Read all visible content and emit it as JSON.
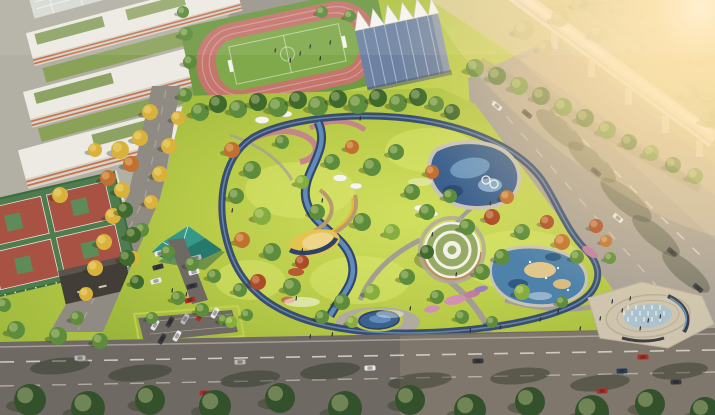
{
  "scene": {
    "label": "aerial-rendering-community-park-masterplan",
    "palette": {
      "lawn": "#aec544",
      "lawnLight": "#d8e468",
      "trackPink": "#c4756c",
      "pitchGreen": "#7fa94b",
      "gymGlass": "#6d82a2",
      "membraneWhite": "#f6f4ef",
      "schoolWhite": "#edeae3",
      "schoolFacade": "#d8d2c8",
      "accentOrange": "#c2764f",
      "roofGreen": "#8ca364",
      "streetGray": "#8f8a82",
      "rightRoad": "#a8a198",
      "bottomRoad": "#6f6963",
      "parkPath": "#a9a399",
      "loopNavy": "#34476b",
      "loopBlue": "#6c93c2",
      "streamBlue": "#5f8cba",
      "water": "#3c618f",
      "waterLight": "#6f9cc6",
      "poolPlay": "#4f82ab",
      "sand": "#e5c351",
      "sandLight": "#e2c78c",
      "pavilionTeal": "#35998a",
      "pavilionTealDark": "#27796d",
      "ringRoofGreen": "#95ab64",
      "ringRoofWhite": "#f3f0e8",
      "courtGreen": "#4e7c4e",
      "courtRed": "#a85244",
      "darkBuilding": "#433d37",
      "viaduct": "#e9e3d9",
      "plaza": "#cfc5ae",
      "fountainWater": "#a7c2d0",
      "glow": "#ffe4b0",
      "treeGreen": "#5d8c3c",
      "treeDark": "#3e6a2d",
      "treeLight": "#86ae3f",
      "treeYellow": "#d9b23c",
      "treeOrange": "#c2702f",
      "treeRed": "#ad4a28",
      "treeHazy": "#a3a86b",
      "treeBottom": "#33522b"
    },
    "carColors": {
      "w": "#e9e9e9",
      "s": "#b9b9b9",
      "d": "#3a3a3f",
      "r": "#b03028",
      "b": "#2e3f5e"
    },
    "trees": [
      [
        200,
        112,
        9,
        "g"
      ],
      [
        218,
        104,
        9,
        "dg"
      ],
      [
        238,
        109,
        9,
        "g"
      ],
      [
        258,
        102,
        9,
        "dg"
      ],
      [
        278,
        107,
        10,
        "g"
      ],
      [
        298,
        100,
        9,
        "dg"
      ],
      [
        318,
        106,
        10,
        "g"
      ],
      [
        338,
        99,
        9,
        "dg"
      ],
      [
        358,
        104,
        10,
        "g"
      ],
      [
        378,
        98,
        9,
        "dg"
      ],
      [
        398,
        103,
        9,
        "g"
      ],
      [
        418,
        97,
        9,
        "dg"
      ],
      [
        436,
        104,
        8,
        "g"
      ],
      [
        452,
        112,
        8,
        "dg"
      ],
      [
        475,
        68,
        9,
        "g"
      ],
      [
        497,
        76,
        9,
        "dg"
      ],
      [
        519,
        86,
        9,
        "g"
      ],
      [
        541,
        96,
        9,
        "dg"
      ],
      [
        563,
        107,
        9,
        "g"
      ],
      [
        585,
        118,
        9,
        "dg"
      ],
      [
        607,
        130,
        9,
        "g"
      ],
      [
        629,
        142,
        8,
        "dg"
      ],
      [
        651,
        153,
        8,
        "g"
      ],
      [
        673,
        165,
        8,
        "dg"
      ],
      [
        695,
        176,
        8,
        "g"
      ],
      [
        150,
        112,
        8,
        "y"
      ],
      [
        140,
        138,
        8,
        "y"
      ],
      [
        131,
        164,
        8,
        "o"
      ],
      [
        122,
        190,
        8,
        "y"
      ],
      [
        113,
        216,
        8,
        "y"
      ],
      [
        104,
        242,
        8,
        "y"
      ],
      [
        95,
        268,
        8,
        "y"
      ],
      [
        86,
        294,
        7,
        "y"
      ],
      [
        77,
        318,
        7,
        "g"
      ],
      [
        178,
        118,
        7,
        "y"
      ],
      [
        169,
        146,
        8,
        "y"
      ],
      [
        160,
        174,
        8,
        "y"
      ],
      [
        151,
        202,
        7,
        "y"
      ],
      [
        142,
        230,
        7,
        "g"
      ],
      [
        133,
        258,
        7,
        "y"
      ],
      [
        120,
        150,
        9,
        "y"
      ],
      [
        108,
        178,
        8,
        "o"
      ],
      [
        60,
        195,
        8,
        "y"
      ],
      [
        95,
        150,
        7,
        "y"
      ],
      [
        185,
        95,
        7,
        "g"
      ],
      [
        125,
        210,
        8,
        "dg"
      ],
      [
        133,
        235,
        8,
        "dg"
      ],
      [
        127,
        258,
        8,
        "dg"
      ],
      [
        137,
        282,
        7,
        "dg"
      ],
      [
        16,
        330,
        9,
        "g"
      ],
      [
        58,
        336,
        9,
        "g"
      ],
      [
        100,
        341,
        8,
        "g"
      ],
      [
        4,
        305,
        7,
        "g"
      ],
      [
        168,
        252,
        7,
        "g"
      ],
      [
        192,
        264,
        7,
        "g"
      ],
      [
        214,
        276,
        7,
        "g"
      ],
      [
        178,
        298,
        7,
        "g"
      ],
      [
        202,
        310,
        7,
        "g"
      ],
      [
        224,
        320,
        6,
        "g"
      ],
      [
        152,
        318,
        6,
        "g"
      ],
      [
        240,
        290,
        7,
        "g"
      ],
      [
        232,
        150,
        8,
        "o"
      ],
      [
        252,
        170,
        9,
        "g"
      ],
      [
        236,
        196,
        8,
        "g"
      ],
      [
        262,
        216,
        9,
        "lg"
      ],
      [
        242,
        240,
        8,
        "o"
      ],
      [
        272,
        252,
        9,
        "g"
      ],
      [
        258,
        282,
        8,
        "r"
      ],
      [
        292,
        287,
        9,
        "g"
      ],
      [
        302,
        262,
        7,
        "r"
      ],
      [
        317,
        212,
        8,
        "g"
      ],
      [
        332,
        162,
        8,
        "g"
      ],
      [
        352,
        147,
        7,
        "o"
      ],
      [
        372,
        167,
        9,
        "g"
      ],
      [
        396,
        152,
        8,
        "g"
      ],
      [
        362,
        222,
        9,
        "g"
      ],
      [
        392,
        232,
        8,
        "lg"
      ],
      [
        412,
        192,
        8,
        "g"
      ],
      [
        432,
        172,
        7,
        "o"
      ],
      [
        427,
        212,
        8,
        "g"
      ],
      [
        450,
        196,
        7,
        "g"
      ],
      [
        467,
        227,
        8,
        "g"
      ],
      [
        492,
        217,
        8,
        "r"
      ],
      [
        507,
        197,
        7,
        "o"
      ],
      [
        522,
        232,
        8,
        "g"
      ],
      [
        547,
        222,
        7,
        "r"
      ],
      [
        562,
        242,
        8,
        "o"
      ],
      [
        577,
        257,
        7,
        "g"
      ],
      [
        502,
        257,
        8,
        "g"
      ],
      [
        482,
        272,
        8,
        "g"
      ],
      [
        522,
        292,
        8,
        "lg"
      ],
      [
        427,
        252,
        7,
        "dg"
      ],
      [
        407,
        277,
        8,
        "g"
      ],
      [
        437,
        297,
        7,
        "g"
      ],
      [
        372,
        292,
        8,
        "lg"
      ],
      [
        342,
        302,
        8,
        "g"
      ],
      [
        322,
        317,
        7,
        "g"
      ],
      [
        352,
        322,
        6,
        "lg"
      ],
      [
        462,
        317,
        7,
        "g"
      ],
      [
        492,
        322,
        6,
        "g"
      ],
      [
        562,
        302,
        6,
        "g"
      ],
      [
        302,
        182,
        7,
        "lg"
      ],
      [
        282,
        142,
        7,
        "g"
      ],
      [
        596,
        226,
        7,
        "r"
      ],
      [
        606,
        241,
        6,
        "o"
      ],
      [
        247,
        315,
        6,
        "g"
      ],
      [
        231,
        322,
        6,
        "lg"
      ],
      [
        610,
        258,
        6,
        "g"
      ],
      [
        524,
        30,
        10,
        "h"
      ],
      [
        560,
        18,
        9,
        "h"
      ],
      [
        598,
        34,
        9,
        "h"
      ],
      [
        638,
        48,
        9,
        "h"
      ],
      [
        664,
        28,
        8,
        "h"
      ],
      [
        700,
        58,
        9,
        "h"
      ],
      [
        620,
        8,
        8,
        "h"
      ],
      [
        690,
        94,
        9,
        "h"
      ],
      [
        708,
        120,
        8,
        "h"
      ],
      [
        580,
        4,
        8,
        "h"
      ],
      [
        545,
        48,
        8,
        "h"
      ],
      [
        30,
        400,
        16,
        "db"
      ],
      [
        88,
        408,
        17,
        "db"
      ],
      [
        150,
        400,
        15,
        "db"
      ],
      [
        215,
        406,
        16,
        "db"
      ],
      [
        280,
        398,
        15,
        "db"
      ],
      [
        345,
        408,
        17,
        "db"
      ],
      [
        410,
        400,
        15,
        "db"
      ],
      [
        470,
        410,
        16,
        "db"
      ],
      [
        530,
        402,
        15,
        "db"
      ],
      [
        592,
        412,
        17,
        "db"
      ],
      [
        650,
        404,
        15,
        "db"
      ],
      [
        705,
        412,
        15,
        "db"
      ],
      [
        190,
        62,
        7,
        "g"
      ],
      [
        186,
        34,
        7,
        "g"
      ],
      [
        183,
        12,
        6,
        "g"
      ],
      [
        350,
        16,
        6,
        "g"
      ],
      [
        322,
        12,
        6,
        "g"
      ]
    ],
    "cars": [
      [
        80,
        358,
        -2,
        "s"
      ],
      [
        240,
        362,
        -2,
        "s"
      ],
      [
        370,
        368,
        -2,
        "w"
      ],
      [
        478,
        361,
        -2,
        "d"
      ],
      [
        602,
        391,
        -2,
        "r"
      ],
      [
        622,
        371,
        -2,
        "b"
      ],
      [
        643,
        357,
        -2,
        "r"
      ],
      [
        676,
        382,
        -2,
        "d"
      ],
      [
        205,
        393,
        -2,
        "r"
      ],
      [
        30,
        390,
        -2,
        "d"
      ],
      [
        530,
        395,
        -2,
        "d"
      ],
      [
        497,
        106,
        40,
        "w"
      ],
      [
        527,
        114,
        40,
        "d"
      ],
      [
        596,
        172,
        40,
        "d"
      ],
      [
        618,
        218,
        40,
        "w"
      ],
      [
        672,
        252,
        40,
        "d"
      ],
      [
        698,
        288,
        40,
        "d"
      ],
      [
        160,
        253,
        -15,
        "w"
      ],
      [
        158,
        267,
        -15,
        "d"
      ],
      [
        156,
        281,
        -15,
        "w"
      ],
      [
        196,
        258,
        -15,
        "s"
      ],
      [
        194,
        272,
        -15,
        "w"
      ],
      [
        192,
        286,
        -15,
        "d"
      ],
      [
        190,
        300,
        -15,
        "r"
      ],
      [
        155,
        325,
        -60,
        "w"
      ],
      [
        170,
        322,
        -60,
        "d"
      ],
      [
        185,
        319,
        -60,
        "s"
      ],
      [
        200,
        316,
        -60,
        "r"
      ],
      [
        215,
        313,
        -60,
        "w"
      ],
      [
        162,
        339,
        -60,
        "d"
      ],
      [
        177,
        336,
        -60,
        "w"
      ]
    ],
    "people": [
      [
        310,
        338
      ],
      [
        332,
        336
      ],
      [
        470,
        332
      ],
      [
        500,
        329
      ],
      [
        540,
        321
      ],
      [
        558,
        313
      ],
      [
        612,
        303
      ],
      [
        622,
        312
      ],
      [
        648,
        322
      ],
      [
        302,
        252
      ],
      [
        322,
        202
      ],
      [
        432,
        236
      ],
      [
        456,
        276
      ],
      [
        232,
        212
      ],
      [
        172,
        292
      ],
      [
        186,
        296
      ],
      [
        630,
        300
      ],
      [
        660,
        318
      ],
      [
        600,
        320
      ],
      [
        490,
        205
      ],
      [
        360,
        120
      ],
      [
        300,
        55
      ],
      [
        310,
        48
      ],
      [
        290,
        62
      ],
      [
        320,
        60
      ],
      [
        275,
        52
      ],
      [
        330,
        44
      ],
      [
        640,
        330
      ],
      [
        580,
        330
      ],
      [
        296,
        300
      ],
      [
        410,
        310
      ]
    ],
    "fountainJets": [
      {
        "y": 309,
        "xs": [
          628,
          636,
          644,
          652,
          660
        ]
      },
      {
        "y": 315,
        "xs": [
          624,
          632,
          640,
          648,
          656,
          664
        ]
      },
      {
        "y": 321,
        "xs": [
          628,
          636,
          644,
          652,
          660
        ]
      }
    ]
  }
}
